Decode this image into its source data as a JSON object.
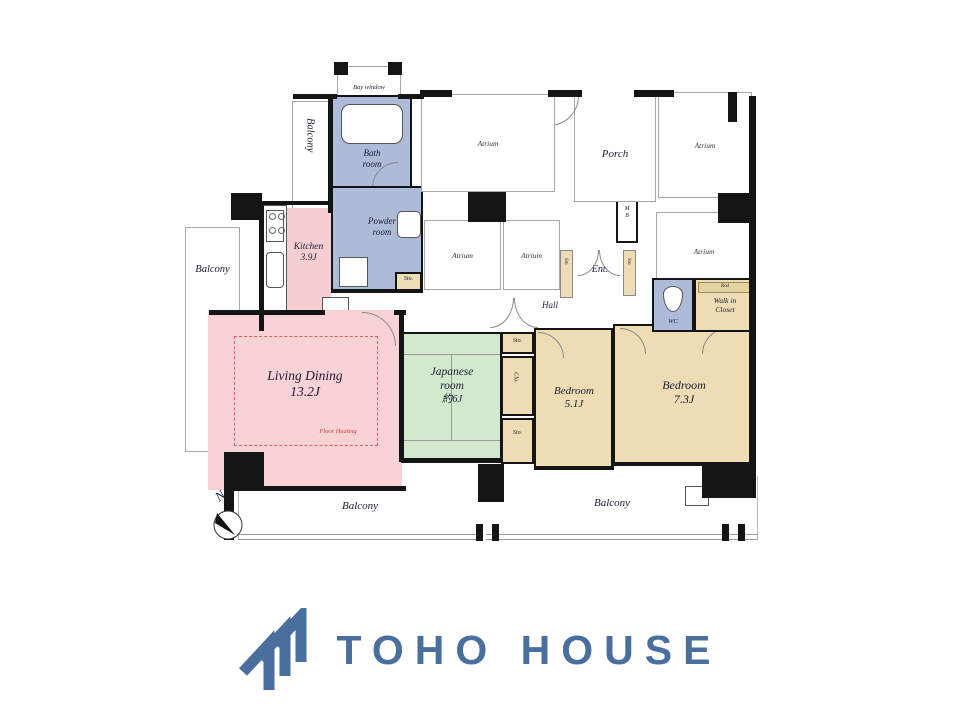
{
  "plan": {
    "balcony": "Balcony",
    "bay_window": "Bay window",
    "bath": {
      "line1": "Bath",
      "line2": "room"
    },
    "sto": "Sto.",
    "powder": {
      "line1": "Powder",
      "line2": "room"
    },
    "kitchen": {
      "line1": "Kitchen",
      "line2": "3.9J"
    },
    "living": {
      "line1": "Living Dining",
      "line2": "13.2J",
      "floor_heating": "Floor Heating"
    },
    "japanese": {
      "line1": "Japanese",
      "line2": "room",
      "line3": "約6J"
    },
    "clo": "Clo.",
    "bedroom_5": {
      "line1": "Bedroom",
      "line2": "5.1J"
    },
    "bedroom_7": {
      "line1": "Bedroom",
      "line2": "7.3J"
    },
    "hall": "Hall",
    "ent": "Ent.",
    "mb": {
      "line1": "M",
      "line2": "B"
    },
    "porch": "Porch",
    "atrium": "Atrium",
    "wc": "WC",
    "walk_in_closet": {
      "line1": "Walk in",
      "line2": "Closet"
    },
    "rod": "Rod",
    "compass_north": "N"
  },
  "footer": {
    "brand": "TOHO HOUSE"
  },
  "colors": {
    "logo_blue": "#4a6f9f",
    "living_pink": "#f8d2d4",
    "kitchen_pink": "#f6ced1",
    "wet_area_blue": "#aebbd8",
    "tatami_green": "#d3e9ce",
    "bedroom_tan": "#eddcb4",
    "floor_heating_red": "#d95f66"
  }
}
